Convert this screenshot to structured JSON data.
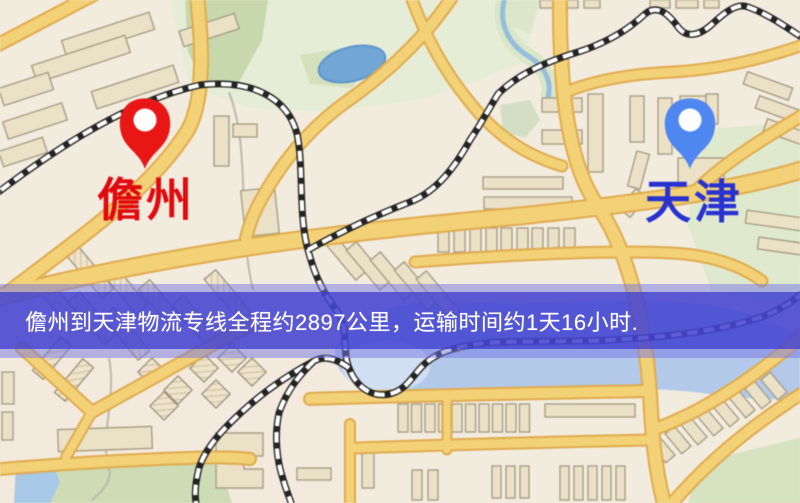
{
  "route_banner": {
    "text": "儋州到天津物流专线全程约2897公里，运输时间约1天16小时.",
    "text_color": "#ffffff",
    "band_outer_color": "rgba(116,118,228,0.50)",
    "band_inner_color": "rgba(62,62,206,0.76)"
  },
  "map": {
    "origin": {
      "name": "儋州",
      "label_color": "#e8070b",
      "pin_color": "#f01414"
    },
    "destination": {
      "name": "天津",
      "label_color": "#2732d6",
      "pin_color": "#4d87f5"
    },
    "palette": {
      "base": "#f2ecdd",
      "road_fill": "#f4d172",
      "road_casing": "#e2ab4a",
      "water": "#6fa6d8",
      "river": "#aac5ec",
      "park": "#c7d8aa",
      "building": "#ebe1c5",
      "railway": "#242424"
    }
  }
}
